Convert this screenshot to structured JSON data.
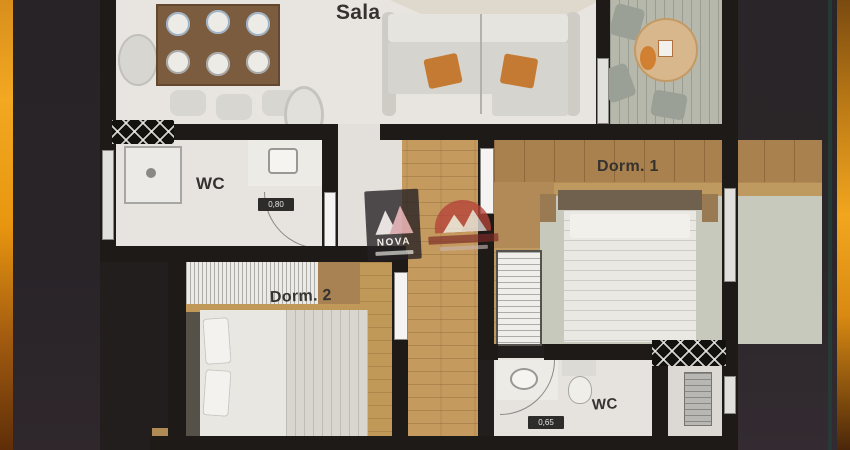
{
  "meta": {
    "type": "apartment floor plan render, top-down 3D",
    "frame": "dark letterbox with golden gradient edge strips"
  },
  "rooms": {
    "sala": {
      "label": "Sala"
    },
    "wc_upper": {
      "label": "WC",
      "door_dimension": "0,80"
    },
    "dorm1": {
      "label": "Dorm. 1"
    },
    "dorm2": {
      "label": "Dorm. 2"
    },
    "wc_lower": {
      "label": "WC",
      "door_dimension": "0,65"
    }
  },
  "watermarks": {
    "badge_text": "NOVA"
  },
  "colors": {
    "gold_accent": "#f2a61e",
    "background_dark": "#2a2528",
    "wall": "#1d1a18",
    "floor_light": "#e8e5e0",
    "floor_wood": "#c49a5e",
    "balcony_deck": "#b6b8ac",
    "label_text": "#35322f",
    "watermark_red": "#b5433a"
  }
}
